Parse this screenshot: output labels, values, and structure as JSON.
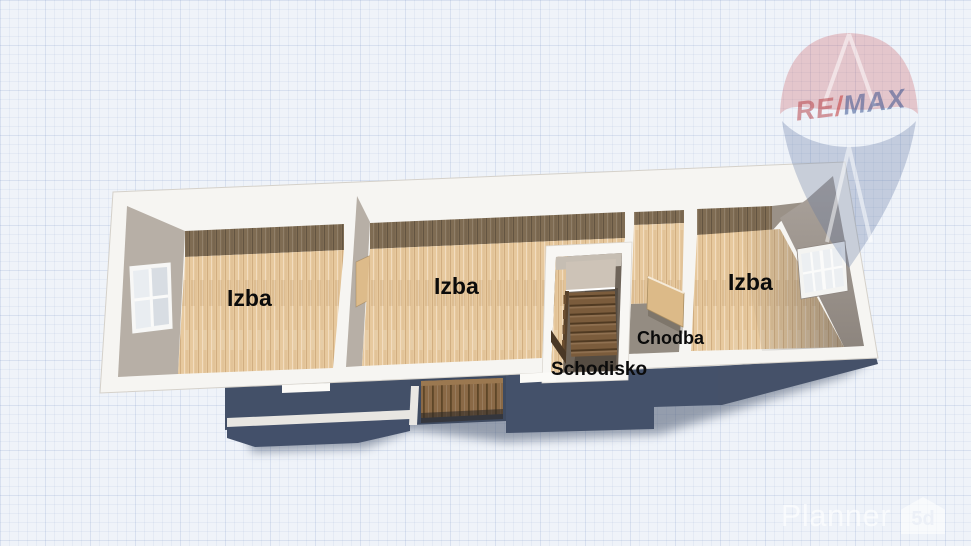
{
  "scene": {
    "view": "3d-floorplan-top-view"
  },
  "floorplan": {
    "labels": [
      {
        "id": "room-left",
        "text": "Izba"
      },
      {
        "id": "room-middle",
        "text": "Izba"
      },
      {
        "id": "room-right",
        "text": "Izba"
      },
      {
        "id": "hallway",
        "text": "Chodba"
      },
      {
        "id": "staircase",
        "text": "Schodisko"
      }
    ]
  },
  "watermarks": {
    "remax": {
      "re": "RE",
      "slash": "/",
      "max": "MAX"
    },
    "planner": {
      "text": "Planner",
      "badge": "5d"
    }
  },
  "colors": {
    "background": "#eff3f9",
    "grid_line": "#c7d4e6",
    "wall": "#f6f5f2",
    "floor_wood": "#e7c99e",
    "floor_shadow_band": "#7f6c53",
    "wall_face": "#b7afa6",
    "lower_floor_shadow": "#44516a",
    "remax_red": "#c23b3e",
    "remax_blue": "#2d4f92",
    "label_text": "#0b0b0b"
  }
}
